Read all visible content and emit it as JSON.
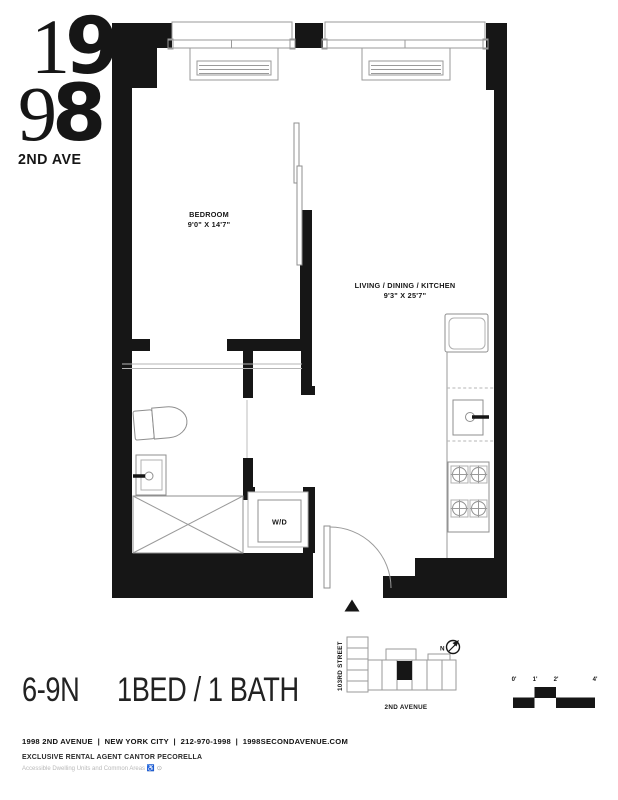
{
  "logo": {
    "line1_thin": "1",
    "line1_heavy": "9",
    "line2_thin": "9",
    "line2_heavy": "8",
    "subtitle": "2ND AVE"
  },
  "plan": {
    "bedroom_label": "BEDROOM",
    "bedroom_dims": "9'0\" X 14'7\"",
    "living_label": "LIVING / DINING / KITCHEN",
    "living_dims": "9'3\" X 25'7\"",
    "washer_dryer_label": "W/D"
  },
  "keyplan": {
    "street_left": "103RD STREET",
    "street_bottom": "2ND AVENUE",
    "north_label": "N"
  },
  "scalebar": {
    "labels": [
      "0'",
      "1'",
      "2'",
      "4'"
    ]
  },
  "title": {
    "unit": "6-9N",
    "layout": "1BED / 1 BATH"
  },
  "footer": {
    "contact": "1998 2ND AVENUE  |  NEW YORK CITY  |  212-970-1998  |  1998SECONDAVENUE.COM",
    "agent": "EXCLUSIVE RENTAL AGENT CANTOR PECORELLA",
    "accessibility": "Accessible Dwelling Units and Common Areas ",
    "accessibility_icons": "♿ ⊙"
  },
  "colors": {
    "ink": "#161616",
    "fixture_stroke": "#8f8f8f",
    "muted_text": "#b9b9b9"
  }
}
